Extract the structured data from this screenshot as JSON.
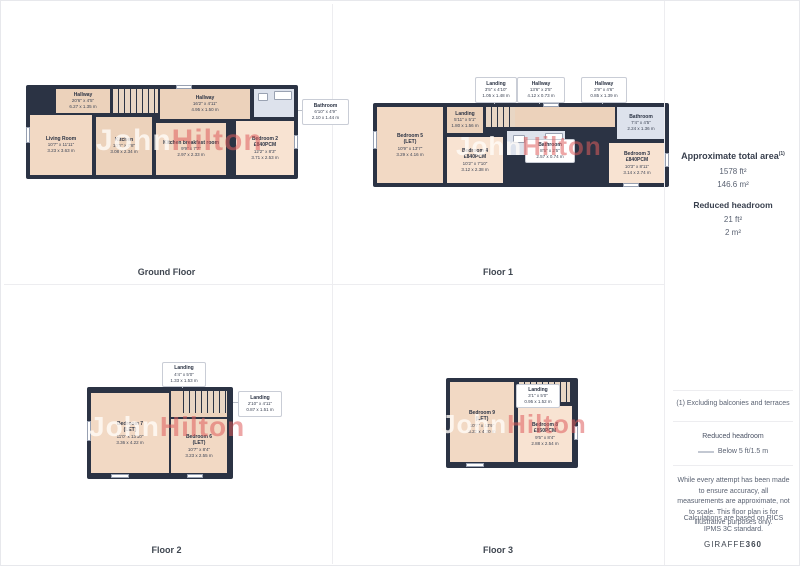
{
  "watermark": {
    "first": "John",
    "second": "Hilton"
  },
  "floors": [
    {
      "title": "Ground Floor",
      "rooms": [
        {
          "name": "Hallway",
          "dims_ft": "20'6\" x 4'5\"",
          "dims_m": "6.27 x 1.35 m"
        },
        {
          "name": "Hallway",
          "dims_ft": "16'2\" x 4'11\"",
          "dims_m": "4.95 x 1.50 m"
        },
        {
          "name": "Living Room",
          "dims_ft": "10'7\" x 11'11\"",
          "dims_m": "3.23 x 3.63 m"
        },
        {
          "name": "Kitchen",
          "dims_ft": "10'1\" x 7'8\"",
          "dims_m": "3.08 x 2.34 m"
        },
        {
          "name": "Kitchen breakfast room",
          "dims_ft": "9'9\" x 7'7\"",
          "dims_m": "2.97 x 2.33 m"
        },
        {
          "name": "Bathroom",
          "dims_ft": "6'10\" x 4'9\"",
          "dims_m": "2.10 x 1.44 m"
        },
        {
          "name": "Bedroom 2",
          "status": "£840PCM",
          "dims_ft": "12'2\" x 8'3\"",
          "dims_m": "3.71 x 2.53 m"
        }
      ]
    },
    {
      "title": "Floor 1",
      "rooms": [
        {
          "name": "Landing",
          "dims_ft": "3'5\" x 4'10\"",
          "dims_m": "1.05 x 1.48 m"
        },
        {
          "name": "Hallway",
          "dims_ft": "13'6\" x 2'5\"",
          "dims_m": "4.12 x 0.73 m"
        },
        {
          "name": "Hallway",
          "dims_ft": "2'9\" x 4'6\"",
          "dims_m": "0.85 x 1.39 m"
        },
        {
          "name": "Landing",
          "dims_ft": "5'11\" x 5'1\"",
          "dims_m": "1.80 x 1.56 m"
        },
        {
          "name": "Bedroom 5",
          "status": "(LET)",
          "dims_ft": "10'9\" x 13'7\"",
          "dims_m": "3.29 x 4.16 m"
        },
        {
          "name": "Bedroom 4",
          "status": "£840PCM",
          "dims_ft": "10'2\" x 7'10\"",
          "dims_m": "3.12 x 2.38 m"
        },
        {
          "name": "Bathroom",
          "dims_ft": "8'5\" x 2'5\"",
          "dims_m": "2.57 x 0.74 m"
        },
        {
          "name": "Bathroom",
          "dims_ft": "7'4\" x 4'5\"",
          "dims_m": "2.24 x 1.36 m"
        },
        {
          "name": "Bedroom 3",
          "status": "£840PCM",
          "dims_ft": "10'3\" x 8'11\"",
          "dims_m": "3.14 x 2.74 m"
        }
      ]
    },
    {
      "title": "Floor 2",
      "rooms": [
        {
          "name": "Landing",
          "dims_ft": "4'4\" x 5'0\"",
          "dims_m": "1.33 x 1.53 m"
        },
        {
          "name": "Landing",
          "dims_ft": "2'10\" x 4'11\"",
          "dims_m": "0.87 x 1.51 m"
        },
        {
          "name": "Bedroom 7",
          "status": "(LET)",
          "dims_ft": "11'0\" x 13'10\"",
          "dims_m": "3.36 x 4.22 m"
        },
        {
          "name": "Bedroom 6",
          "status": "(LET)",
          "dims_ft": "10'7\" x 8'4\"",
          "dims_m": "3.23 x 2.55 m"
        }
      ]
    },
    {
      "title": "Floor 3",
      "rooms": [
        {
          "name": "Landing",
          "dims_ft": "3'1\" x 5'0\"",
          "dims_m": "0.95 x 1.52 m"
        },
        {
          "name": "Bedroom 9",
          "status": "(LET)",
          "dims_ft": "10'7\" x 13'9\"",
          "dims_m": "3.22 x 4.20 m"
        },
        {
          "name": "Bedroom 8",
          "status": "£850PCM",
          "dims_ft": "9'5\" x 8'4\"",
          "dims_m": "2.88 x 2.54 m"
        }
      ]
    }
  ],
  "sidebar": {
    "total_area_title": "Approximate total area",
    "total_area_sup": "(1)",
    "total_area_ft": "1578 ft²",
    "total_area_m": "146.6 m²",
    "reduced_headroom_title": "Reduced headroom",
    "reduced_headroom_ft": "21 ft²",
    "reduced_headroom_m": "2 m²",
    "footnote": "(1) Excluding balconies and terraces",
    "legend_title": "Reduced headroom",
    "legend_item": "Below 5 ft/1.5 m",
    "disclaimer": "While every attempt has been made to ensure accuracy, all measurements are approximate, not to scale. This floor plan is for illustrative purposes only.",
    "standard": "Calculations are based on RICS IPMS 3C standard.",
    "brand": "GIRAFFE",
    "brand_bold": "360"
  },
  "colors": {
    "wall": "#2b3344",
    "room": "#f2d9c4",
    "bathroom": "#dde2ec",
    "watermark_red": "#df5d5d"
  }
}
